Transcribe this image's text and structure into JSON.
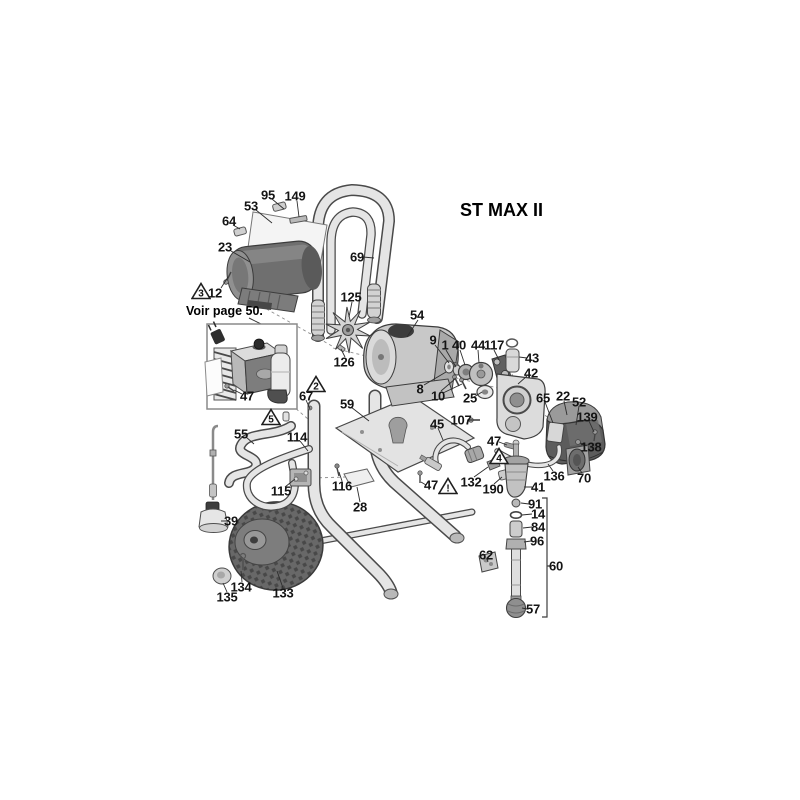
{
  "title": "ST MAX II",
  "note": "Voir page 50.",
  "colors": {
    "line": "#3f3f3f",
    "label_text": "#141414",
    "fill_light": "#e8e8e8",
    "fill_mid": "#b5b5b5",
    "fill_dark": "#5f5f5f",
    "background": "#ffffff"
  },
  "diagram": {
    "parts": [
      {
        "id": "95",
        "num": "95",
        "x": 268,
        "y": 195
      },
      {
        "id": "149",
        "num": "149",
        "x": 295,
        "y": 196
      },
      {
        "id": "53",
        "num": "53",
        "x": 251,
        "y": 206
      },
      {
        "id": "64",
        "num": "64",
        "x": 229,
        "y": 221
      },
      {
        "id": "23",
        "num": "23",
        "x": 225,
        "y": 247
      },
      {
        "id": "12",
        "num": "12",
        "x": 215,
        "y": 293
      },
      {
        "id": "69",
        "num": "69",
        "x": 357,
        "y": 257
      },
      {
        "id": "125",
        "num": "125",
        "x": 351,
        "y": 297
      },
      {
        "id": "54",
        "num": "54",
        "x": 417,
        "y": 315
      },
      {
        "id": "126",
        "num": "126",
        "x": 344,
        "y": 362
      },
      {
        "id": "9",
        "num": "9",
        "x": 433,
        "y": 340
      },
      {
        "id": "1",
        "num": "1",
        "x": 445,
        "y": 345
      },
      {
        "id": "40",
        "num": "40",
        "x": 459,
        "y": 345
      },
      {
        "id": "44",
        "num": "44",
        "x": 478,
        "y": 345
      },
      {
        "id": "117",
        "num": "117",
        "x": 494,
        "y": 345
      },
      {
        "id": "43",
        "num": "43",
        "x": 532,
        "y": 358
      },
      {
        "id": "42",
        "num": "42",
        "x": 531,
        "y": 373
      },
      {
        "id": "8",
        "num": "8",
        "x": 420,
        "y": 389
      },
      {
        "id": "10",
        "num": "10",
        "x": 438,
        "y": 396
      },
      {
        "id": "25",
        "num": "25",
        "x": 470,
        "y": 398
      },
      {
        "id": "65",
        "num": "65",
        "x": 543,
        "y": 398
      },
      {
        "id": "22",
        "num": "22",
        "x": 563,
        "y": 396
      },
      {
        "id": "52",
        "num": "52",
        "x": 579,
        "y": 402
      },
      {
        "id": "139",
        "num": "139",
        "x": 587,
        "y": 417
      },
      {
        "id": "138",
        "num": "138",
        "x": 591,
        "y": 447
      },
      {
        "id": "67",
        "num": "67",
        "x": 306,
        "y": 396
      },
      {
        "id": "59",
        "num": "59",
        "x": 347,
        "y": 404
      },
      {
        "id": "107",
        "num": "107",
        "x": 461,
        "y": 420
      },
      {
        "id": "45",
        "num": "45",
        "x": 437,
        "y": 424
      },
      {
        "id": "47a",
        "num": "47",
        "x": 247,
        "y": 396
      },
      {
        "id": "47b",
        "num": "47",
        "x": 494,
        "y": 441
      },
      {
        "id": "47c",
        "num": "47",
        "x": 431,
        "y": 485
      },
      {
        "id": "55",
        "num": "55",
        "x": 241,
        "y": 434
      },
      {
        "id": "114",
        "num": "114",
        "x": 297,
        "y": 437
      },
      {
        "id": "115",
        "num": "115",
        "x": 281,
        "y": 491
      },
      {
        "id": "116",
        "num": "116",
        "x": 342,
        "y": 486
      },
      {
        "id": "28",
        "num": "28",
        "x": 360,
        "y": 507
      },
      {
        "id": "132",
        "num": "132",
        "x": 471,
        "y": 482
      },
      {
        "id": "190",
        "num": "190",
        "x": 493,
        "y": 489
      },
      {
        "id": "41",
        "num": "41",
        "x": 538,
        "y": 487
      },
      {
        "id": "136",
        "num": "136",
        "x": 554,
        "y": 476
      },
      {
        "id": "70",
        "num": "70",
        "x": 584,
        "y": 478
      },
      {
        "id": "39",
        "num": "39",
        "x": 231,
        "y": 521
      },
      {
        "id": "91",
        "num": "91",
        "x": 535,
        "y": 504
      },
      {
        "id": "14",
        "num": "14",
        "x": 538,
        "y": 514
      },
      {
        "id": "84",
        "num": "84",
        "x": 538,
        "y": 527
      },
      {
        "id": "96",
        "num": "96",
        "x": 537,
        "y": 541
      },
      {
        "id": "62",
        "num": "62",
        "x": 486,
        "y": 555
      },
      {
        "id": "60",
        "num": "60",
        "x": 556,
        "y": 566
      },
      {
        "id": "57",
        "num": "57",
        "x": 533,
        "y": 609
      },
      {
        "id": "134",
        "num": "134",
        "x": 241,
        "y": 587
      },
      {
        "id": "135",
        "num": "135",
        "x": 227,
        "y": 597
      },
      {
        "id": "133",
        "num": "133",
        "x": 283,
        "y": 593
      }
    ],
    "warnings": [
      {
        "symbol": "3",
        "x": 201,
        "y": 291
      },
      {
        "symbol": "2",
        "x": 316,
        "y": 384
      },
      {
        "symbol": "5",
        "x": 271,
        "y": 417
      },
      {
        "symbol": "4",
        "x": 499,
        "y": 456
      },
      {
        "symbol": "!",
        "x": 448,
        "y": 486
      }
    ]
  }
}
